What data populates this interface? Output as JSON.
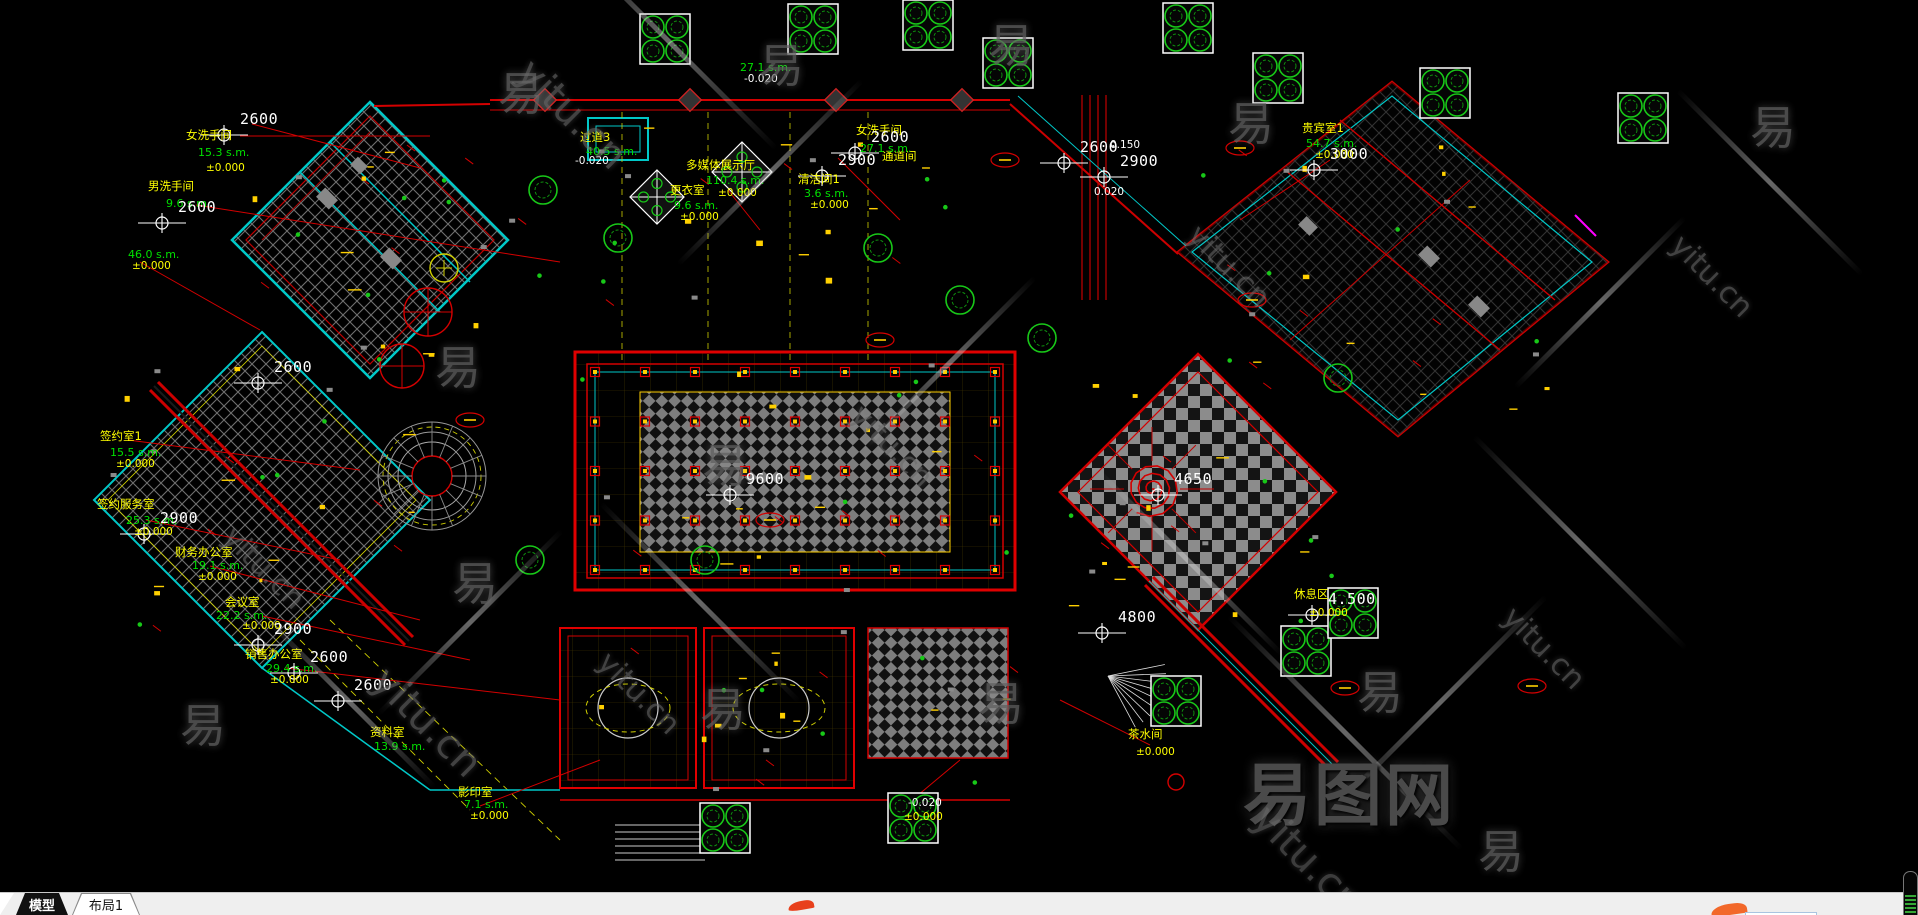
{
  "colors": {
    "canvas_bg": "#000000",
    "line_red": "#d40000",
    "wall_cyan": "#00c8c8",
    "hatch_gray": "#8a8a8a",
    "room_text": "#ffff00",
    "area_text": "#00e000",
    "dim_text": "#ffffff",
    "tree_green": "#18c818",
    "watermark_gray": "#636363",
    "logo_orange": "#f2682a"
  },
  "tab_bar": {
    "tabs": [
      {
        "label": "模型",
        "active": true
      },
      {
        "label": "布局1",
        "active": false
      }
    ]
  },
  "watermark": {
    "glyph": "易",
    "url": "yitu.cn",
    "brand": "易图网"
  },
  "drawing": {
    "room_labels": [
      {
        "t": "女洗手间",
        "x": 186,
        "y": 130
      },
      {
        "t": "男洗手间",
        "x": 148,
        "y": 181
      },
      {
        "t": "签约室1",
        "x": 100,
        "y": 431
      },
      {
        "t": "签约服务室",
        "x": 97,
        "y": 499
      },
      {
        "t": "财务办公室",
        "x": 175,
        "y": 547
      },
      {
        "t": "会议室",
        "x": 225,
        "y": 597
      },
      {
        "t": "销售办公室",
        "x": 245,
        "y": 649
      },
      {
        "t": "资料室",
        "x": 370,
        "y": 727
      },
      {
        "t": "影印室",
        "x": 458,
        "y": 787
      },
      {
        "t": "多媒体展示厅",
        "x": 686,
        "y": 160
      },
      {
        "t": "更衣室",
        "x": 670,
        "y": 185
      },
      {
        "t": "过道3",
        "x": 580,
        "y": 132
      },
      {
        "t": "清洁间1",
        "x": 798,
        "y": 174
      },
      {
        "t": "女洗手间",
        "x": 856,
        "y": 125
      },
      {
        "t": "通道间",
        "x": 882,
        "y": 151
      },
      {
        "t": "贵宾室1",
        "x": 1302,
        "y": 123
      },
      {
        "t": "休息区",
        "x": 1294,
        "y": 589
      },
      {
        "t": "茶水间",
        "x": 1128,
        "y": 729
      }
    ],
    "area_labels": [
      {
        "t": "15.3 s.m.",
        "x": 198,
        "y": 147
      },
      {
        "t": "9.6 s.m.",
        "x": 166,
        "y": 198
      },
      {
        "t": "46.0 s.m.",
        "x": 128,
        "y": 249
      },
      {
        "t": "15.5 s.m.",
        "x": 110,
        "y": 447
      },
      {
        "t": "25.3 s.m.",
        "x": 126,
        "y": 515
      },
      {
        "t": "19.1 s.m.",
        "x": 192,
        "y": 560
      },
      {
        "t": "22.2 s.m.",
        "x": 216,
        "y": 610
      },
      {
        "t": "29.4 s.m.",
        "x": 266,
        "y": 663
      },
      {
        "t": "13.9 s.m.",
        "x": 374,
        "y": 741
      },
      {
        "t": "7.1 s.m.",
        "x": 464,
        "y": 799
      },
      {
        "t": "110.4 s.m.",
        "x": 706,
        "y": 175
      },
      {
        "t": "9.6 s.m.",
        "x": 674,
        "y": 200
      },
      {
        "t": "40.5 s.m.",
        "x": 586,
        "y": 146
      },
      {
        "t": "3.6 s.m.",
        "x": 804,
        "y": 188
      },
      {
        "t": "27.1 s.m.",
        "x": 860,
        "y": 143
      },
      {
        "t": "27.1 s.m.",
        "x": 740,
        "y": 62
      },
      {
        "t": "54.7 s.m.",
        "x": 1306,
        "y": 138
      }
    ],
    "level_labels": [
      {
        "t": "±0.000",
        "x": 206,
        "y": 163
      },
      {
        "t": "±0.000",
        "x": 132,
        "y": 261
      },
      {
        "t": "±0.000",
        "x": 116,
        "y": 459
      },
      {
        "t": "±0.000",
        "x": 134,
        "y": 527
      },
      {
        "t": "±0.000",
        "x": 198,
        "y": 572
      },
      {
        "t": "±0.000",
        "x": 242,
        "y": 621
      },
      {
        "t": "±0.000",
        "x": 270,
        "y": 675
      },
      {
        "t": "±0.000",
        "x": 470,
        "y": 811
      },
      {
        "t": "±0.000",
        "x": 718,
        "y": 188
      },
      {
        "t": "±0.000",
        "x": 810,
        "y": 200
      },
      {
        "t": "±0.000",
        "x": 680,
        "y": 212
      },
      {
        "t": "±0.000",
        "x": 1315,
        "y": 150
      },
      {
        "t": "±0.000",
        "x": 1309,
        "y": 608
      },
      {
        "t": "±0.000",
        "x": 1136,
        "y": 747
      },
      {
        "t": "±0.000",
        "x": 904,
        "y": 812
      },
      {
        "t": "-0.020",
        "x": 575,
        "y": 156,
        "c": "#ffffff"
      },
      {
        "t": "-0.020",
        "x": 744,
        "y": 74,
        "c": "#ffffff"
      },
      {
        "t": "-0.020",
        "x": 908,
        "y": 798,
        "c": "#ffffff"
      },
      {
        "t": "0.150",
        "x": 1110,
        "y": 140,
        "c": "#ffffff"
      },
      {
        "t": "0.020",
        "x": 1094,
        "y": 187,
        "c": "#ffffff"
      }
    ],
    "dim_labels": [
      {
        "t": "2600",
        "x": 240,
        "y": 112
      },
      {
        "t": "2600",
        "x": 178,
        "y": 200
      },
      {
        "t": "2600",
        "x": 274,
        "y": 360
      },
      {
        "t": "2900",
        "x": 160,
        "y": 511
      },
      {
        "t": "2900",
        "x": 274,
        "y": 622
      },
      {
        "t": "2600",
        "x": 310,
        "y": 650
      },
      {
        "t": "2600",
        "x": 354,
        "y": 678
      },
      {
        "t": "2600",
        "x": 871,
        "y": 130
      },
      {
        "t": "2900",
        "x": 838,
        "y": 153
      },
      {
        "t": "2600",
        "x": 1080,
        "y": 140
      },
      {
        "t": "2900",
        "x": 1120,
        "y": 154
      },
      {
        "t": "9600",
        "x": 746,
        "y": 472
      },
      {
        "t": "4650",
        "x": 1174,
        "y": 472
      },
      {
        "t": "4800",
        "x": 1118,
        "y": 610
      },
      {
        "t": "4.500",
        "x": 1328,
        "y": 592
      },
      {
        "t": "3000",
        "x": 1330,
        "y": 147
      }
    ]
  }
}
